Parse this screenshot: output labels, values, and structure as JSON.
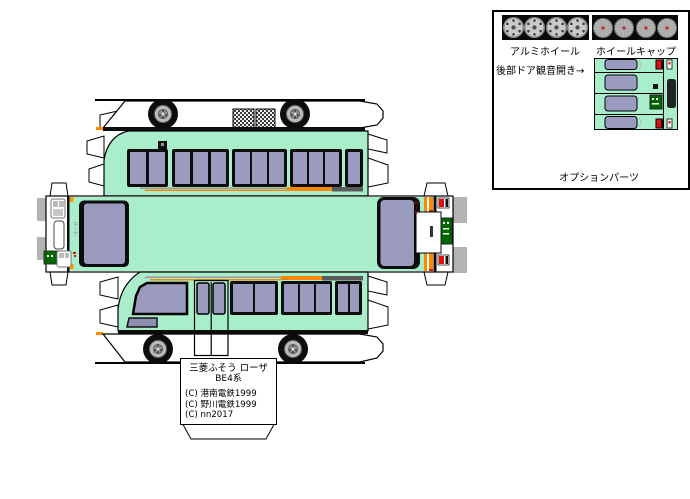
{
  "sheet": {
    "title_box": {
      "model_line1": "三菱ふそう ローザ",
      "model_line2": "BE4系",
      "credits": [
        "(C) 港南電鉄1999",
        "(C) 野川電鉄1999",
        "(C) nn2017"
      ]
    },
    "logos": {
      "front": "ローザ",
      "rear": "ローザ"
    },
    "options": {
      "aluminum_label": "アルミホイール",
      "cap_label": "ホイールキャップ",
      "rear_door_note": "後部ドア観音開き→",
      "panel_label": "オプションパーツ"
    }
  },
  "colors": {
    "body_mint": "#a9eecb",
    "window_purple": "#9b9bbf",
    "stripe_orange": "#ff8800",
    "stripe_dark": "#5a5a5a",
    "plate_green": "#006600",
    "tire_black": "#0d0d0d",
    "tab_gray": "#b3b3b3"
  }
}
